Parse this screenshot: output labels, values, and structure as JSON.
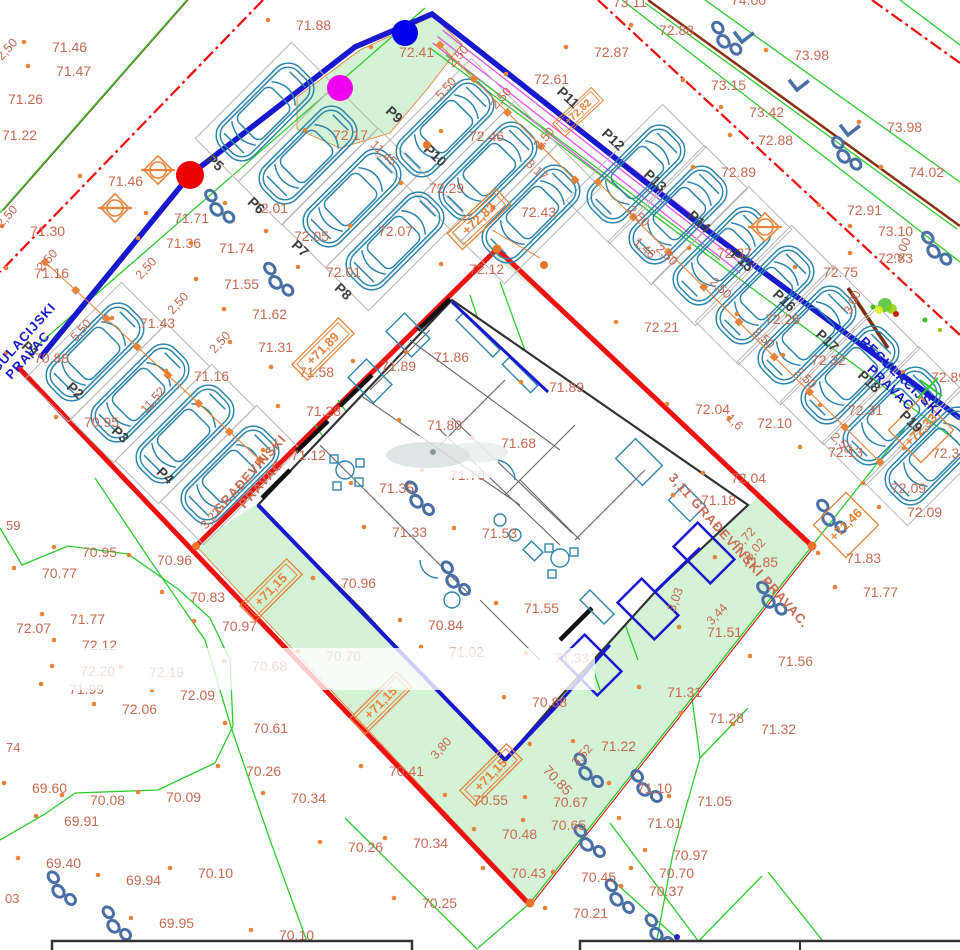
{
  "title": "Situacija - parkiralište i građevina (site plan)",
  "colors": {
    "label": "#c96a52",
    "orange": "#e8833a",
    "red": "#ee1111",
    "blue": "#1818cf",
    "green_line": "#2ccc2c",
    "green_fill": "#d4f2d4",
    "road": "#8b2f10",
    "cyan": "#2e86ad",
    "magenta": "#e62ee6",
    "bush": "#4a6fa5",
    "wall": "#333333",
    "ptext": "#3f3f3f",
    "dot_red": "#ee0000",
    "dot_blue": "#0000ee",
    "dot_magenta": "#ee00ee"
  },
  "boundary_texts": [
    {
      "lines": [
        "REGULACIJSKI",
        "PRAVAC"
      ],
      "x": 20,
      "y": 348,
      "r": -48,
      "cls": "btext-blue"
    },
    {
      "lines": [
        "REGULACIJSKI",
        "PRAVAC"
      ],
      "x": 898,
      "y": 380,
      "r": 44,
      "cls": "btext-blue"
    },
    {
      "lines": [
        "GRAĐEVINSKI",
        "PRAVAC"
      ],
      "x": 253,
      "y": 477,
      "r": -48,
      "cls": "btext-sal"
    },
    {
      "lines": [
        "3,11 GRAĐEVINSKI PRAVAC."
      ],
      "x": 668,
      "y": 478,
      "r": 48,
      "cls": "btext-sal",
      "anchor": "start"
    }
  ],
  "spot_elevations": [
    {
      "t": "71.88",
      "x": 296,
      "y": 30
    },
    {
      "t": "71.46",
      "x": 52,
      "y": 52
    },
    {
      "t": "71.47",
      "x": 56,
      "y": 76
    },
    {
      "t": "71.26",
      "x": 8,
      "y": 104
    },
    {
      "t": "71.22",
      "x": 2,
      "y": 140
    },
    {
      "t": "71.46",
      "x": 108,
      "y": 186
    },
    {
      "t": "71.30",
      "x": 30,
      "y": 236
    },
    {
      "t": "71.16",
      "x": 34,
      "y": 278
    },
    {
      "t": "71.71",
      "x": 174,
      "y": 223
    },
    {
      "t": "71.36",
      "x": 166,
      "y": 248
    },
    {
      "t": "71.74",
      "x": 219,
      "y": 253
    },
    {
      "t": "71.55",
      "x": 224,
      "y": 289
    },
    {
      "t": "71.62",
      "x": 252,
      "y": 319
    },
    {
      "t": "71.31",
      "x": 258,
      "y": 352
    },
    {
      "t": "71.43",
      "x": 140,
      "y": 328
    },
    {
      "t": "71.16",
      "x": 194,
      "y": 381
    },
    {
      "t": "70.88",
      "x": 34,
      "y": 363
    },
    {
      "t": "70.95",
      "x": 84,
      "y": 427
    },
    {
      "t": "71.58",
      "x": 299,
      "y": 377
    },
    {
      "t": "71.28",
      "x": 306,
      "y": 416
    },
    {
      "t": "71.12",
      "x": 291,
      "y": 460
    },
    {
      "t": "72.17",
      "x": 333,
      "y": 140
    },
    {
      "t": "72.41",
      "x": 399,
      "y": 57
    },
    {
      "t": "72.01",
      "x": 253,
      "y": 213
    },
    {
      "t": "72.05",
      "x": 294,
      "y": 241
    },
    {
      "t": "72.07",
      "x": 378,
      "y": 236
    },
    {
      "t": "72.01",
      "x": 326,
      "y": 277
    },
    {
      "t": "72.29",
      "x": 429,
      "y": 193
    },
    {
      "t": "72.46",
      "x": 469,
      "y": 141
    },
    {
      "t": "72.43",
      "x": 521,
      "y": 217
    },
    {
      "t": "72.61",
      "x": 534,
      "y": 84
    },
    {
      "t": "72.87",
      "x": 594,
      "y": 57
    },
    {
      "t": "72.12",
      "x": 469,
      "y": 274
    },
    {
      "t": "73.11",
      "x": 613,
      "y": 7
    },
    {
      "t": "74.00",
      "x": 731,
      "y": 5
    },
    {
      "t": "72.88",
      "x": 659,
      "y": 35
    },
    {
      "t": "73.98",
      "x": 794,
      "y": 60
    },
    {
      "t": "73.15",
      "x": 711,
      "y": 90
    },
    {
      "t": "73.42",
      "x": 749,
      "y": 117
    },
    {
      "t": "72.88",
      "x": 758,
      "y": 145
    },
    {
      "t": "73.98",
      "x": 887,
      "y": 132
    },
    {
      "t": "74.02",
      "x": 909,
      "y": 177
    },
    {
      "t": "72.89",
      "x": 721,
      "y": 177
    },
    {
      "t": "72.91",
      "x": 847,
      "y": 215
    },
    {
      "t": "73.10",
      "x": 878,
      "y": 236
    },
    {
      "t": "72.83",
      "x": 878,
      "y": 263
    },
    {
      "t": "72.75",
      "x": 823,
      "y": 277
    },
    {
      "t": "72.89",
      "x": 931,
      "y": 382
    },
    {
      "t": "72.37",
      "x": 932,
      "y": 458
    },
    {
      "t": "72.21",
      "x": 644,
      "y": 332
    },
    {
      "t": "72.37",
      "x": 717,
      "y": 258
    },
    {
      "t": "72.26",
      "x": 765,
      "y": 324
    },
    {
      "t": "72.32",
      "x": 811,
      "y": 365
    },
    {
      "t": "72.31",
      "x": 848,
      "y": 415
    },
    {
      "t": "72.13",
      "x": 828,
      "y": 457
    },
    {
      "t": "72.10",
      "x": 757,
      "y": 428
    },
    {
      "t": "72.04",
      "x": 695,
      "y": 414
    },
    {
      "t": "72.04",
      "x": 731,
      "y": 483
    },
    {
      "t": "72.09",
      "x": 891,
      "y": 493
    },
    {
      "t": "72.09",
      "x": 907,
      "y": 517
    },
    {
      "t": "71.18",
      "x": 701,
      "y": 505
    },
    {
      "t": "71.89",
      "x": 381,
      "y": 371
    },
    {
      "t": "71.86",
      "x": 434,
      "y": 362
    },
    {
      "t": "71.89",
      "x": 549,
      "y": 392
    },
    {
      "t": "71.80",
      "x": 427,
      "y": 430
    },
    {
      "t": "71.68",
      "x": 501,
      "y": 448
    },
    {
      "t": "71.70",
      "x": 450,
      "y": 480
    },
    {
      "t": "71.35",
      "x": 379,
      "y": 493
    },
    {
      "t": "71.33",
      "x": 392,
      "y": 537
    },
    {
      "t": "71.53",
      "x": 482,
      "y": 538
    },
    {
      "t": "71.55",
      "x": 524,
      "y": 613
    },
    {
      "t": "70.96",
      "x": 341,
      "y": 588
    },
    {
      "t": "70.88",
      "x": 532,
      "y": 707
    },
    {
      "t": "71.02",
      "x": 449,
      "y": 657
    },
    {
      "t": "70.84",
      "x": 428,
      "y": 630
    },
    {
      "t": "71.33",
      "x": 554,
      "y": 663
    },
    {
      "t": "70.85",
      "x": 542,
      "y": 771,
      "r": 46
    },
    {
      "t": "70.70",
      "x": 326,
      "y": 661
    },
    {
      "t": "70.41",
      "x": 389,
      "y": 776
    },
    {
      "t": "70.55",
      "x": 473,
      "y": 805
    },
    {
      "t": "70.48",
      "x": 502,
      "y": 839
    },
    {
      "t": "70.65",
      "x": 551,
      "y": 830
    },
    {
      "t": "70.67",
      "x": 553,
      "y": 807
    },
    {
      "t": "70.43",
      "x": 511,
      "y": 878
    },
    {
      "t": "70.45",
      "x": 581,
      "y": 882
    },
    {
      "t": "70.25",
      "x": 422,
      "y": 908
    },
    {
      "t": "70.21",
      "x": 573,
      "y": 918
    },
    {
      "t": "70.10",
      "x": 279,
      "y": 940
    },
    {
      "t": "69.95",
      "x": 159,
      "y": 928
    },
    {
      "t": "69.94",
      "x": 126,
      "y": 885
    },
    {
      "t": "70.10",
      "x": 198,
      "y": 878
    },
    {
      "t": "70.26",
      "x": 348,
      "y": 852
    },
    {
      "t": "70.34",
      "x": 413,
      "y": 848
    },
    {
      "t": "70.08",
      "x": 90,
      "y": 805
    },
    {
      "t": "70.09",
      "x": 166,
      "y": 802
    },
    {
      "t": "69.91",
      "x": 64,
      "y": 826
    },
    {
      "t": "69.60",
      "x": 32,
      "y": 793
    },
    {
      "t": "69.40",
      "x": 46,
      "y": 868
    },
    {
      "t": "70.34",
      "x": 291,
      "y": 803
    },
    {
      "t": "70.26",
      "x": 246,
      "y": 776
    },
    {
      "t": "70.61",
      "x": 253,
      "y": 733
    },
    {
      "t": "70.77",
      "x": 42,
      "y": 578
    },
    {
      "t": "70.95",
      "x": 82,
      "y": 557
    },
    {
      "t": "70.96",
      "x": 157,
      "y": 565
    },
    {
      "t": "70.83",
      "x": 190,
      "y": 602
    },
    {
      "t": "70.97",
      "x": 222,
      "y": 631
    },
    {
      "t": "70.68",
      "x": 252,
      "y": 671
    },
    {
      "t": "71.77",
      "x": 70,
      "y": 624
    },
    {
      "t": "72.07",
      "x": 16,
      "y": 633
    },
    {
      "t": "72.12",
      "x": 82,
      "y": 650
    },
    {
      "t": "72.20",
      "x": 80,
      "y": 676
    },
    {
      "t": "72.19",
      "x": 149,
      "y": 677
    },
    {
      "t": "71.99",
      "x": 69,
      "y": 694
    },
    {
      "t": "72.06",
      "x": 122,
      "y": 714
    },
    {
      "t": "72.09",
      "x": 180,
      "y": 700
    },
    {
      "t": "71.85",
      "x": 743,
      "y": 567
    },
    {
      "t": "71.83",
      "x": 846,
      "y": 563
    },
    {
      "t": "71.77",
      "x": 863,
      "y": 597
    },
    {
      "t": "71.51",
      "x": 707,
      "y": 637
    },
    {
      "t": "71.56",
      "x": 778,
      "y": 666
    },
    {
      "t": "71.31",
      "x": 667,
      "y": 697
    },
    {
      "t": "71.28",
      "x": 709,
      "y": 723
    },
    {
      "t": "71.32",
      "x": 761,
      "y": 734
    },
    {
      "t": "71.22",
      "x": 601,
      "y": 751
    },
    {
      "t": "71.10",
      "x": 637,
      "y": 793
    },
    {
      "t": "71.05",
      "x": 697,
      "y": 806
    },
    {
      "t": "71.01",
      "x": 647,
      "y": 828
    },
    {
      "t": "70.97",
      "x": 673,
      "y": 860
    },
    {
      "t": "70.70",
      "x": 659,
      "y": 878
    },
    {
      "t": "70.37",
      "x": 649,
      "y": 896
    },
    {
      "t": "59",
      "x": 6,
      "y": 530
    },
    {
      "t": "74",
      "x": 6,
      "y": 752
    },
    {
      "t": "03",
      "x": 5,
      "y": 903
    }
  ],
  "dimensions": [
    {
      "t": "2,50",
      "x": 10,
      "y": 52,
      "r": -48
    },
    {
      "t": "2,50",
      "x": 10,
      "y": 219,
      "r": -48
    },
    {
      "t": "2,50",
      "x": 50,
      "y": 263,
      "r": -48
    },
    {
      "t": "2,50",
      "x": 149,
      "y": 271,
      "r": -48
    },
    {
      "t": "2,50",
      "x": 181,
      "y": 306,
      "r": -48
    },
    {
      "t": "2,50",
      "x": 223,
      "y": 345,
      "r": -48
    },
    {
      "t": "5,50",
      "x": 84,
      "y": 333,
      "r": -48
    },
    {
      "t": "11,52",
      "x": 156,
      "y": 403,
      "r": -48
    },
    {
      "t": "2,50",
      "x": 461,
      "y": 59,
      "r": -48
    },
    {
      "t": "2,50",
      "x": 504,
      "y": 101,
      "r": -48
    },
    {
      "t": "2,50",
      "x": 547,
      "y": 141,
      "r": -48
    },
    {
      "t": "5,50",
      "x": 449,
      "y": 91,
      "r": -48
    },
    {
      "t": "11,45",
      "x": 381,
      "y": 156,
      "r": 43
    },
    {
      "t": "8,17",
      "x": 534,
      "y": 173,
      "r": 43
    },
    {
      "t": "2,50",
      "x": 636,
      "y": 219,
      "r": 43
    },
    {
      "t": "2,50",
      "x": 664,
      "y": 258,
      "r": 43
    },
    {
      "t": "2,50",
      "x": 718,
      "y": 291,
      "r": 43
    },
    {
      "t": "2,50",
      "x": 761,
      "y": 341,
      "r": 43
    },
    {
      "t": "2,50",
      "x": 803,
      "y": 381,
      "r": 43
    },
    {
      "t": "2,50",
      "x": 839,
      "y": 446,
      "r": 43
    },
    {
      "t": "1,46",
      "x": 642,
      "y": 251,
      "r": 43
    },
    {
      "t": "1,6",
      "x": 732,
      "y": 425,
      "r": 43
    },
    {
      "t": "3,22",
      "x": 214,
      "y": 521,
      "r": -48
    },
    {
      "t": "3,80",
      "x": 444,
      "y": 751,
      "r": -48
    },
    {
      "t": "3,00",
      "x": 906,
      "y": 251,
      "r": -65
    },
    {
      "t": "3,00",
      "x": 856,
      "y": 304,
      "r": -65
    },
    {
      "t": "3,03",
      "x": 679,
      "y": 601,
      "r": -70
    },
    {
      "t": "3,44",
      "x": 720,
      "y": 617,
      "r": -47
    },
    {
      "t": "3,02",
      "x": 758,
      "y": 552,
      "r": -48
    },
    {
      "t": "3,72",
      "x": 748,
      "y": 541,
      "r": -48
    },
    {
      "t": "3,52",
      "x": 585,
      "y": 758,
      "r": -48
    }
  ],
  "boxed_elevations": [
    {
      "t": "+72,82",
      "x": 479,
      "y": 219,
      "r": -43
    },
    {
      "t": "+72,82",
      "x": 578,
      "y": 112,
      "r": -43,
      "s": 0.8
    },
    {
      "t": "+71,89",
      "x": 323,
      "y": 349,
      "r": -45
    },
    {
      "t": "+71,15",
      "x": 271,
      "y": 590,
      "r": -45
    },
    {
      "t": "+71,15",
      "x": 381,
      "y": 703,
      "r": -45
    },
    {
      "t": "+71,15",
      "x": 491,
      "y": 775,
      "r": -45
    },
    {
      "t": "+72,33",
      "x": 921,
      "y": 430,
      "r": -45,
      "d": 1
    },
    {
      "t": "+71,46",
      "x": 846,
      "y": 525,
      "r": -45,
      "d": 1
    }
  ],
  "parking_stalls": [
    {
      "id": "P1",
      "lx": 27,
      "ly": 353,
      "cx": 95,
      "cy": 352,
      "a": -45
    },
    {
      "id": "P2",
      "lx": 72,
      "ly": 394,
      "cx": 140,
      "cy": 393,
      "a": -45
    },
    {
      "id": "P3",
      "lx": 117,
      "ly": 438,
      "cx": 185,
      "cy": 434,
      "a": -45
    },
    {
      "id": "P4",
      "lx": 162,
      "ly": 479,
      "cx": 230,
      "cy": 475,
      "a": -45
    },
    {
      "id": "P5",
      "lx": 212,
      "ly": 166,
      "cx": 265,
      "cy": 112,
      "a": -45
    },
    {
      "id": "P6",
      "lx": 253,
      "ly": 209,
      "cx": 308,
      "cy": 155,
      "a": -45
    },
    {
      "id": "P7",
      "lx": 297,
      "ly": 252,
      "cx": 352,
      "cy": 198,
      "a": -45
    },
    {
      "id": "P8",
      "lx": 340,
      "ly": 295,
      "cx": 395,
      "cy": 241,
      "a": -45
    },
    {
      "id": "P9",
      "lx": 391,
      "ly": 118,
      "cx": 445,
      "cy": 128,
      "a": 135
    },
    {
      "id": "P10",
      "lx": 432,
      "ly": 159,
      "cx": 488,
      "cy": 171,
      "a": 135
    },
    {
      "id": "P11",
      "lx": 565,
      "ly": 101,
      "cx": 531,
      "cy": 214,
      "a": 135
    },
    {
      "id": "P12",
      "lx": 610,
      "ly": 143,
      "cx": 636,
      "cy": 174,
      "a": 135
    },
    {
      "id": "P13",
      "lx": 652,
      "ly": 184,
      "cx": 678,
      "cy": 215,
      "a": 135
    },
    {
      "id": "P14",
      "lx": 696,
      "ly": 225,
      "cx": 722,
      "cy": 256,
      "a": 135
    },
    {
      "id": "P15",
      "lx": 739,
      "ly": 264,
      "cx": 765,
      "cy": 295,
      "a": 135
    },
    {
      "id": "P16",
      "lx": 781,
      "ly": 304,
      "cx": 807,
      "cy": 335,
      "a": 135
    },
    {
      "id": "P17",
      "lx": 824,
      "ly": 344,
      "cx": 850,
      "cy": 375,
      "a": 135
    },
    {
      "id": "P18",
      "lx": 866,
      "ly": 385,
      "cx": 892,
      "cy": 416,
      "a": 135
    },
    {
      "id": "P19",
      "lx": 908,
      "ly": 425,
      "cx": 934,
      "cy": 456,
      "a": 135
    }
  ],
  "symbols": {
    "bushes": [
      [
        218,
        208,
        48
      ],
      [
        277,
        281,
        48
      ],
      [
        418,
        500,
        50
      ],
      [
        454,
        580,
        50
      ],
      [
        587,
        772,
        50
      ],
      [
        588,
        843,
        45
      ],
      [
        645,
        788,
        45
      ],
      [
        770,
        600,
        48
      ],
      [
        830,
        518,
        48
      ],
      [
        725,
        40,
        48
      ],
      [
        845,
        155,
        48
      ],
      [
        935,
        250,
        48
      ],
      [
        60,
        890,
        50
      ],
      [
        115,
        925,
        50
      ],
      [
        618,
        898,
        50
      ],
      [
        658,
        933,
        50
      ]
    ],
    "trees": [
      [
        158,
        170
      ],
      [
        115,
        208
      ],
      [
        765,
        227
      ]
    ],
    "scrub_tree": [
      885,
      305
    ],
    "level_marks": [
      [
        742,
        42
      ],
      [
        797,
        90
      ],
      [
        848,
        135
      ]
    ]
  },
  "dots": {
    "red": [
      190,
      175
    ],
    "blue": [
      405,
      33
    ],
    "magenta": [
      340,
      88
    ],
    "blue_small": [
      677,
      937
    ]
  }
}
